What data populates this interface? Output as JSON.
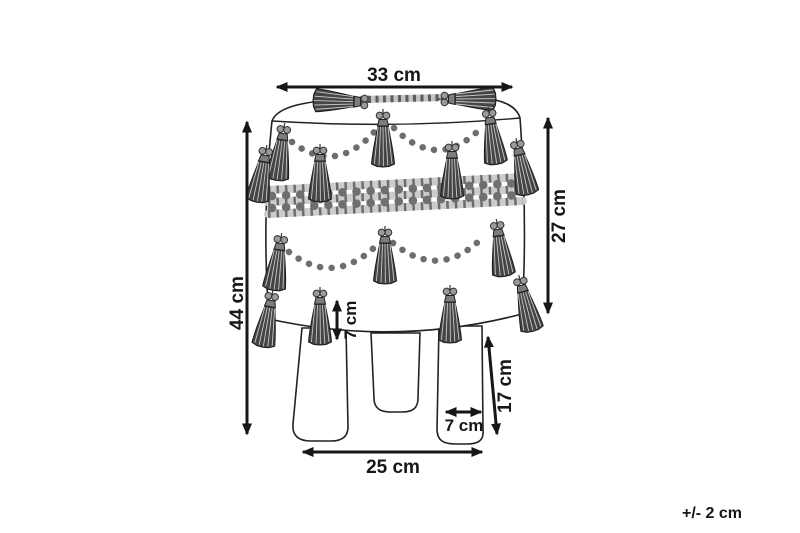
{
  "canvas": {
    "background": "#ffffff",
    "ink": "#161616",
    "subject": "pouf-with-tassels-three-legs-front-view"
  },
  "dimensions": {
    "top_width": "33 cm",
    "overall_height": "44 cm",
    "body_height": "27 cm",
    "tassel_drop": "7 cm",
    "leg_height": "17 cm",
    "leg_width": "7 cm",
    "base_width": "25 cm"
  },
  "tolerance_note": "+/- 2 cm"
}
